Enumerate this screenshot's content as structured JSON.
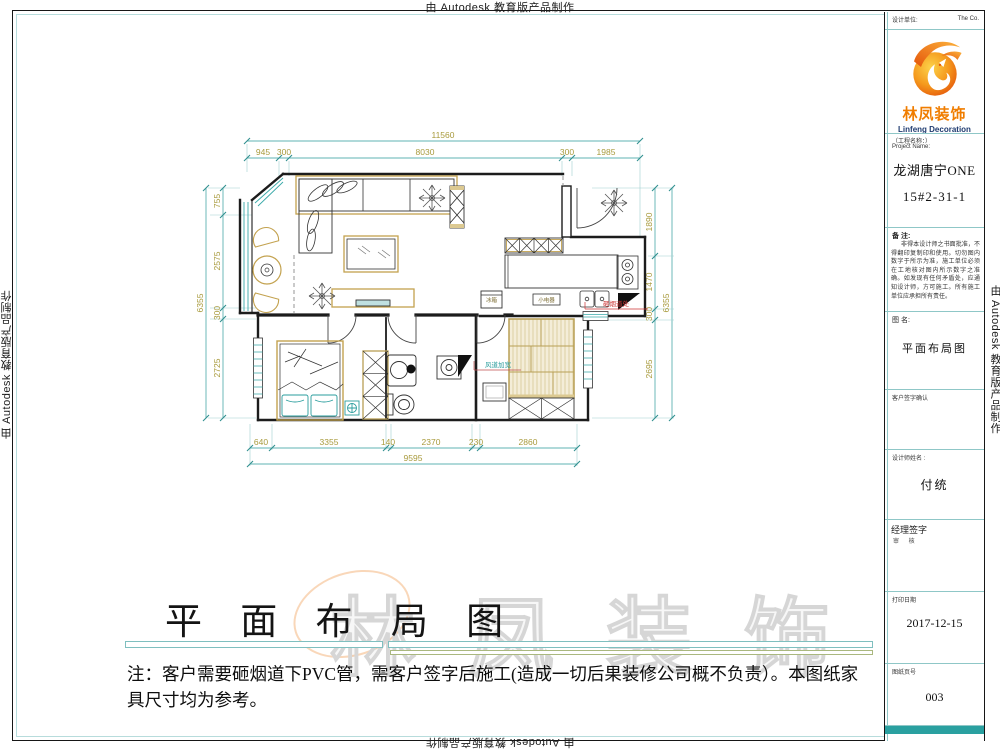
{
  "edge_text": "由 Autodesk 教育版产品制作",
  "colors": {
    "accent_teal": "#3aa9a9",
    "dim_text_olive": "#a89a3c",
    "brand_orange": "#f07d00",
    "logo_blue": "#1f3b70",
    "annotation_red": "#cc3333",
    "footer_bar_teal": "#2aa0a0"
  },
  "title_block": {
    "design_unit_label": "设计单位:",
    "design_unit_right": "The  Co.",
    "company_cn": "林凤装饰",
    "company_en": "Linfeng Decoration",
    "project_label_cn": "（工程名称：）",
    "project_label_en": "Project Name:",
    "project_name": "龙湖唐宁ONE",
    "project_unit": "15#2-31-1",
    "remark_label": "备  注:",
    "remark_text": "非得本设计师之书面批准，不得翻印复制印和使用。切勿图内数字于所示为准，施工单位必须在工地核对图内所示数字之准确。如发现有任何矛盾处，应通知设计师，方可施工。所有施工单位应承担所有责任。",
    "drawing_name_label": "图  名:",
    "drawing_name": "平面布局图",
    "customer_sign_label": "客户签字确认",
    "designer_label": "设计师姓名 :",
    "designer_name": "付统",
    "manager_sign_label": "经理签字",
    "manager_review_label": "审  核",
    "print_date_label": "打印日期",
    "print_date": "2017-12-15",
    "page_label": "图纸页号",
    "page_number": "003"
  },
  "main_title": "平 面 布 局 图",
  "watermark_text": "林凤装饰",
  "note_text": "注：客户需要砸烟道下PVC管，需客户签字后施工(造成一切后果装修公司概不负责）。本图纸家具尺寸均为参考。",
  "plan_labels": {
    "fridge": "冰箱",
    "small_appliance": "小电器",
    "flue_note_red": "砸烟道处",
    "duct_note_teal": "风道加宽"
  },
  "dimensions": {
    "top": {
      "overall": "11560",
      "segments": [
        "945",
        "300",
        "8030",
        "300",
        "1985"
      ]
    },
    "left": {
      "overall": "6355",
      "segments": [
        "755",
        "2575",
        "300",
        "2725"
      ]
    },
    "right": {
      "overall": "6355",
      "segments": [
        "1890",
        "1470",
        "300",
        "2695"
      ]
    },
    "bottom": {
      "overall": "9595",
      "segments": [
        "640",
        "3355",
        "140",
        "2370",
        "230",
        "2860"
      ]
    }
  }
}
